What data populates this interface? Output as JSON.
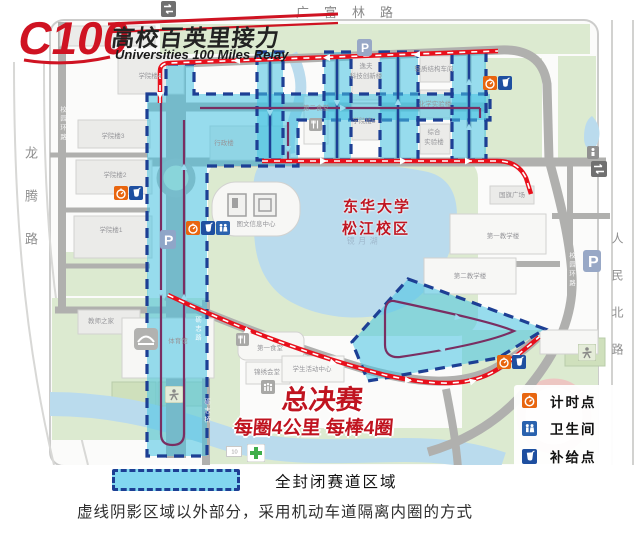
{
  "logo": {
    "mark": "C100",
    "title": "高校百英里接力",
    "subtitle": "Universities 100 Miles Relay"
  },
  "roads": {
    "top": "广富林路",
    "left": "龙腾路",
    "right": "人民北路",
    "ring_west": "校园环路",
    "ring_east": "校园环路",
    "lizhi_road": "砺志路",
    "lizhi_bridge": "砺志桥"
  },
  "campus": {
    "university": "东华大学",
    "campus_name": "松江校区",
    "lake": "镜月湖"
  },
  "buildings": [
    {
      "label": "学院楼4"
    },
    {
      "label": "学院楼3"
    },
    {
      "label": "学院楼2"
    },
    {
      "label": "学院楼1"
    },
    {
      "label": "教师之家"
    },
    {
      "label": "体育馆"
    },
    {
      "line1": "逸夫",
      "line2": "科技创新楼"
    },
    {
      "label": "轻质结构车间"
    },
    {
      "label": "化学实验楼"
    },
    {
      "line1": "综合",
      "line2": "实验楼"
    },
    {
      "label": "学院楼5"
    },
    {
      "label": "第二食堂"
    },
    {
      "label": "行政楼"
    },
    {
      "label": "图文信息中心"
    },
    {
      "label": "国旗广场"
    },
    {
      "label": "第一教学楼"
    },
    {
      "label": "第二教学楼"
    },
    {
      "label": "第一食堂"
    },
    {
      "label": "锦绣会堂"
    },
    {
      "label": "学生活动中心"
    }
  ],
  "race": {
    "title": "总决赛",
    "detail": "每圈4公里 每棒4圈"
  },
  "legend": {
    "timing": "计时点",
    "restroom": "卫生间",
    "supply": "补给点"
  },
  "footer": {
    "closed_area": "全封闭赛道区域",
    "note": "虚线阴影区域以外部分，采用机动车道隔离内圈的方式"
  },
  "markers": {
    "parking": "P",
    "bridge_no": "10"
  },
  "colors": {
    "route_red": "#e8101c",
    "course_fill": "#45c3e2",
    "course_border": "#1d3f94",
    "timing_orange": "#e8650f",
    "supply_blue": "#1e4fa0",
    "restroom_blue": "#2a62ae",
    "race_red": "#c01420"
  }
}
